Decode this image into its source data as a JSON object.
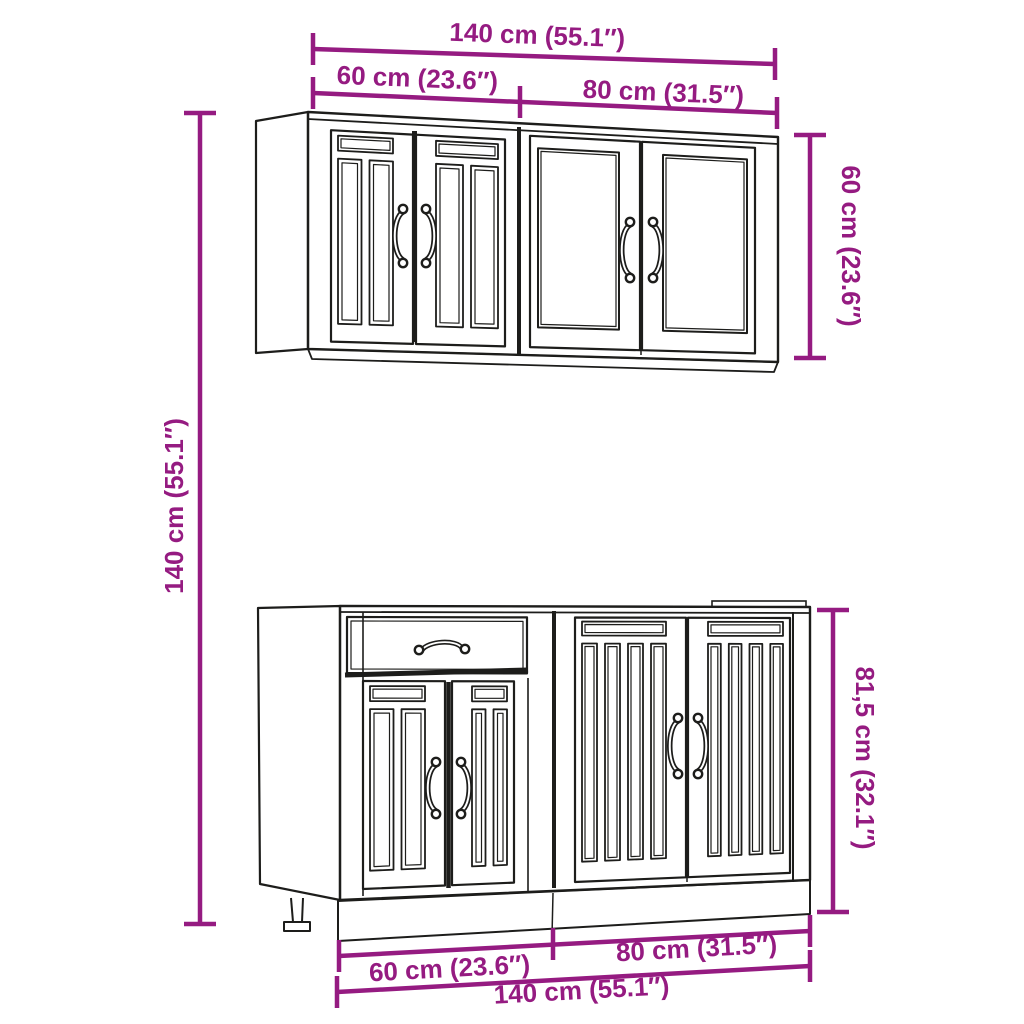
{
  "colors": {
    "background": "#ffffff",
    "dimension": "#951b81",
    "linework": "#1d1d1b"
  },
  "diagram_type": "kitchen-cabinet-set-dimension-drawing",
  "dimensions": {
    "top_total": "140 cm (55.1″)",
    "top_left_segment": "60 cm (23.6″)",
    "top_right_segment": "80 cm (31.5″)",
    "side_right_upper": "60 cm (23.6″)",
    "side_left": "140 cm (55.1″)",
    "side_right_lower": "81,5 cm (32.1″)",
    "bottom_left_segment": "60 cm (23.6″)",
    "bottom_right_segment": "80 cm (31.5″)",
    "bottom_total": "140 cm (55.1″)"
  }
}
